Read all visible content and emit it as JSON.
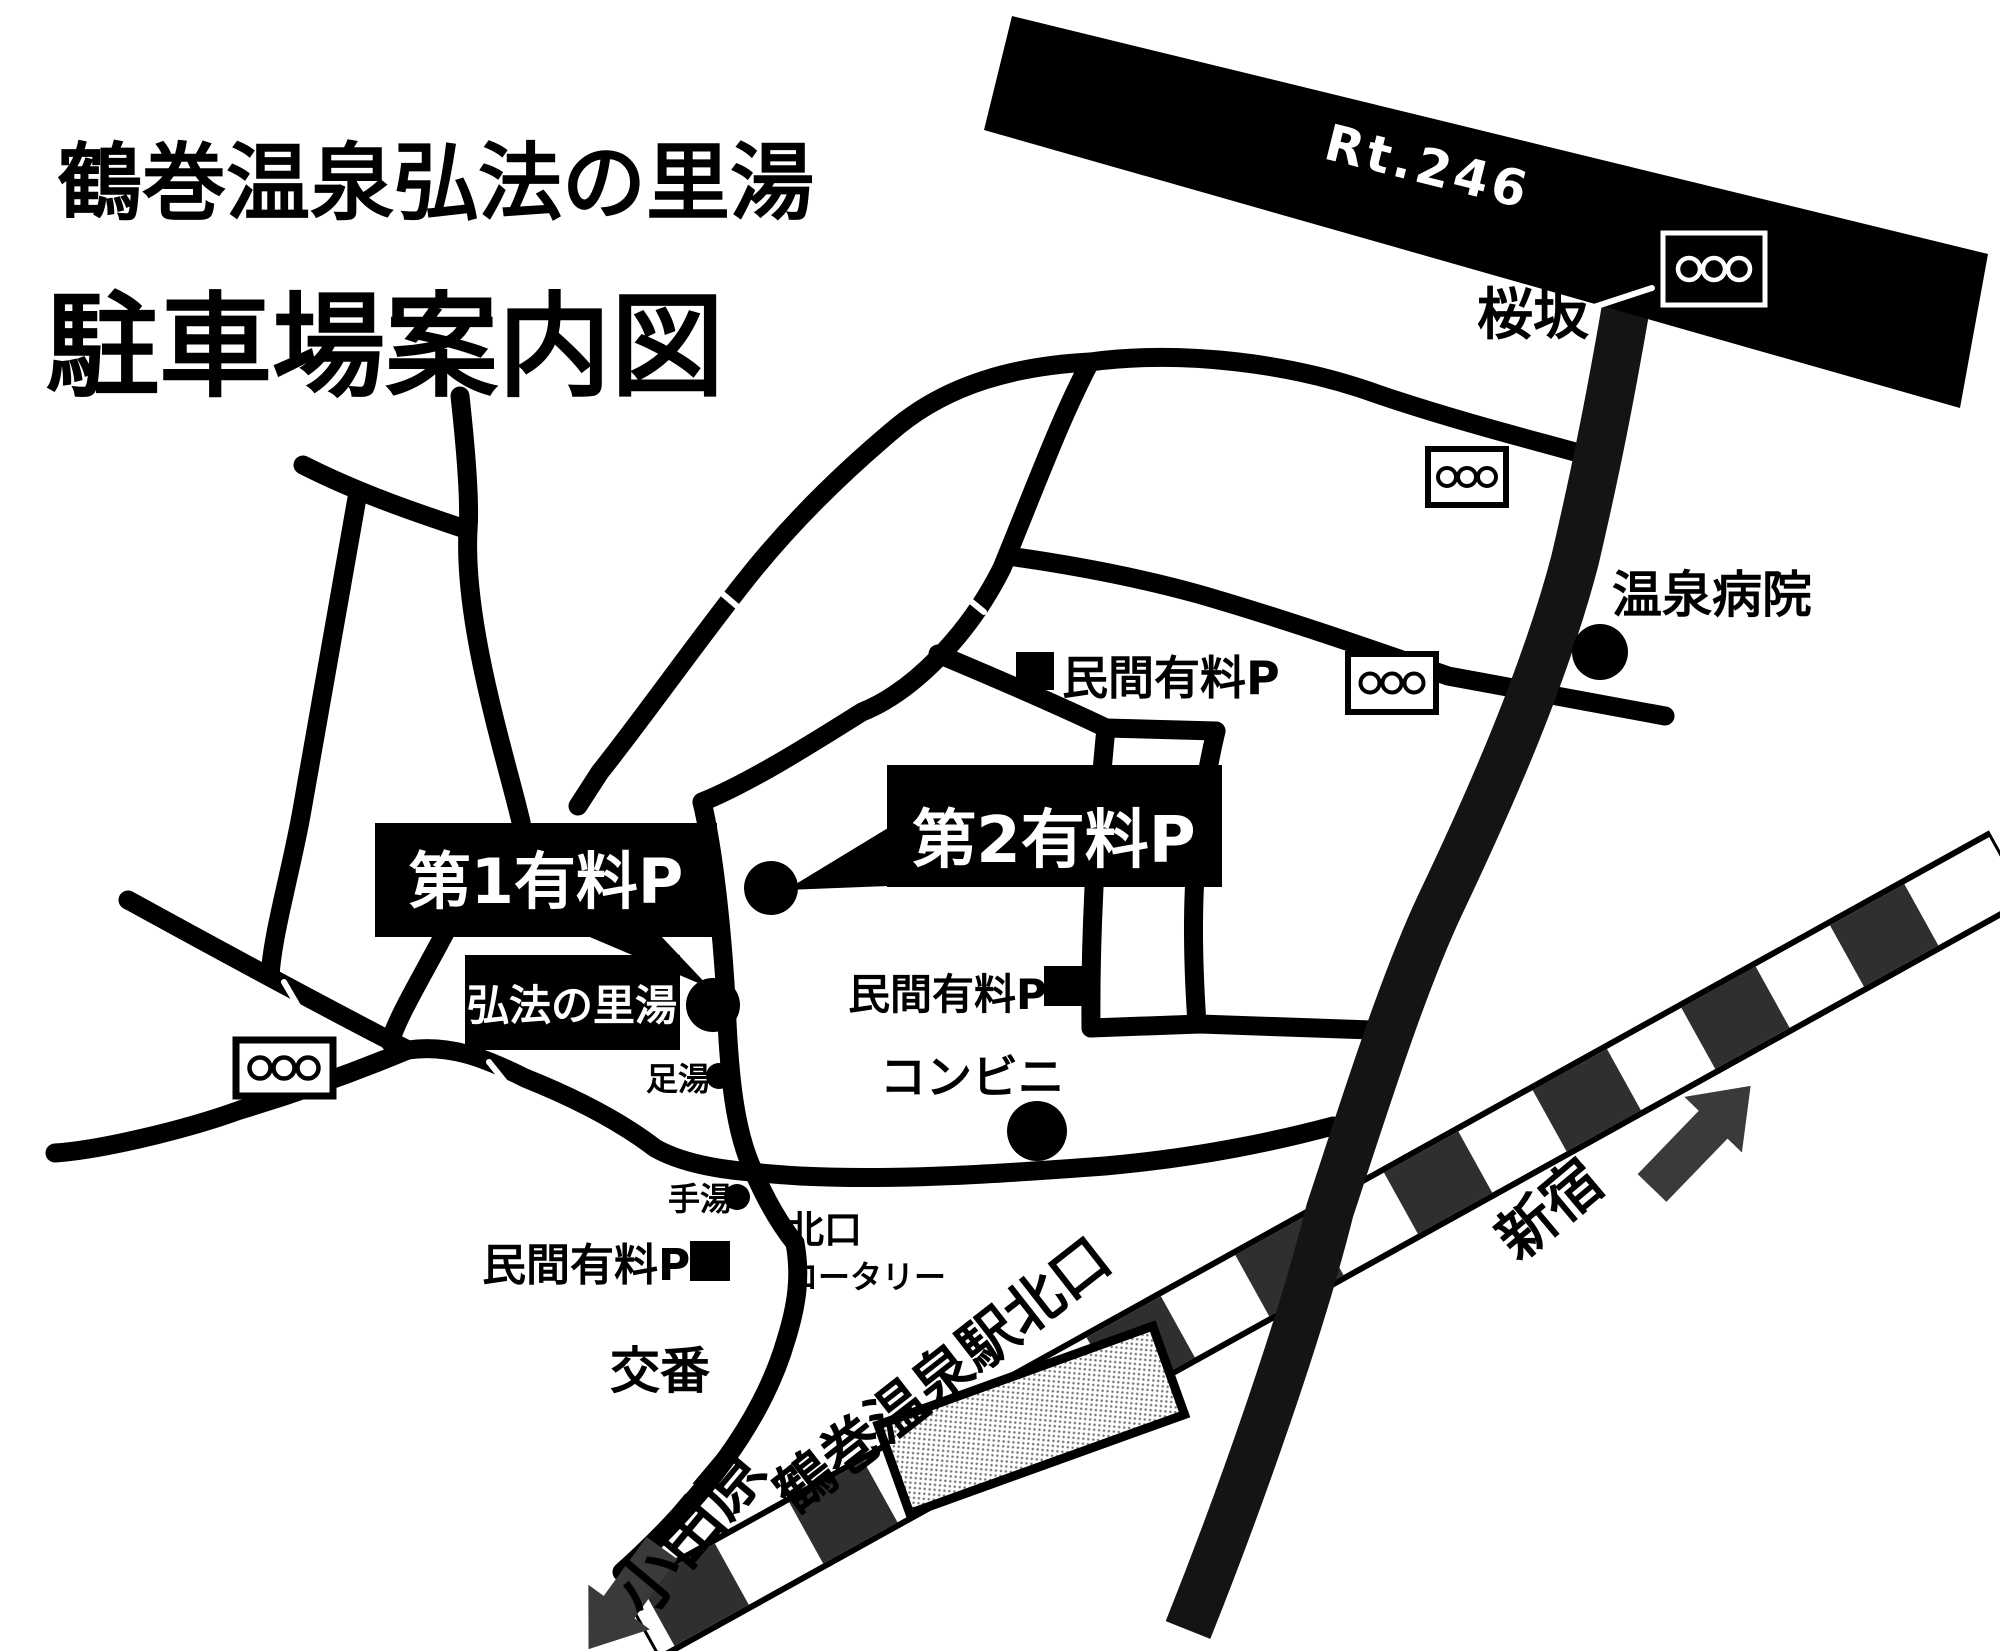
{
  "map": {
    "title": {
      "line1": "鶴巻温泉弘法の里湯",
      "line2": "駐車場案内図"
    },
    "roads": {
      "route246_label": "Rt.246",
      "sakurazaka_label": "桜坂"
    },
    "places": {
      "onsen_hospital": "温泉病院",
      "private_paid_p_top": "民間有料P",
      "paid_p2": "第2有料P",
      "paid_p1": "第1有料P",
      "kobo_no_satoyu": "弘法の里湯",
      "ashiyu": "足湯",
      "private_paid_p_mid": "民間有料P",
      "convenience_store": "コンビニ",
      "teyu": "手湯",
      "private_paid_p_bottom": "民間有料P",
      "north_rotary_line1": "北口",
      "north_rotary_line2": "ロータリー",
      "police_box": "交番"
    },
    "railway": {
      "station_north_exit": "鶴巻温泉駅北口",
      "dir_west": "小田原",
      "dir_east": "新宿"
    },
    "legend": {
      "traffic_signal_icon": "ooo",
      "spot_dot_icon": "black-dot",
      "private_parking_icon": "black-square"
    },
    "colors": {
      "ink": "#000000",
      "sakurazaka_road": "#141414",
      "rail_stripe": "#2f2f2f",
      "arrow": "#3a3a3a",
      "paper": "#ffffff"
    }
  }
}
